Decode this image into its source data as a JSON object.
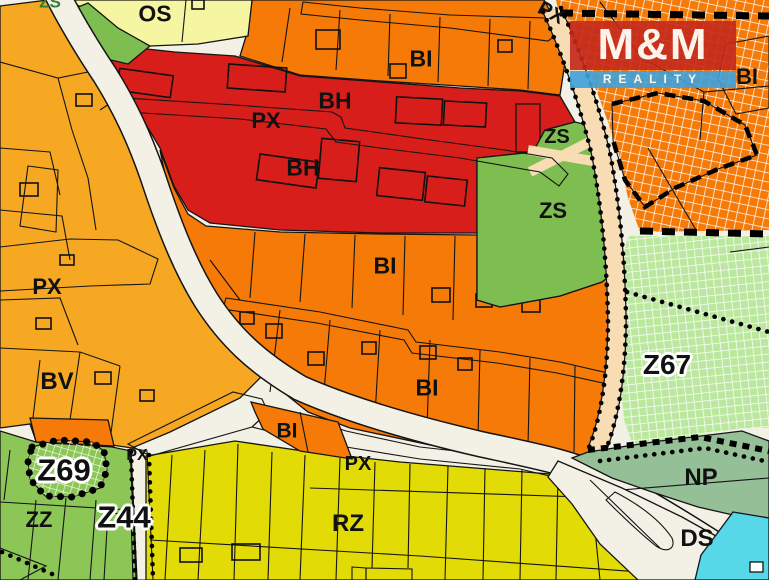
{
  "map": {
    "type": "zoning-plan-map",
    "colors": {
      "bi": "#F57A07",
      "bh": "#D81E1A",
      "bv": "#F7A823",
      "os": "#F6F6A2",
      "zs": "#7EBE51",
      "z67": "#BCE79E",
      "np": "#95BF97",
      "rz": "#E2DB06",
      "zz": "#8CC656",
      "water": "#57D8E9",
      "road": "#F3F0E6",
      "tan": "#F8DCB3",
      "z69": "#F6AC2F",
      "cream": "#F4E3C3",
      "logoRed": "#C5281C",
      "logoBlue": "#3FA3DC",
      "line": "#141414"
    },
    "zone_codes": [
      "BI",
      "BH",
      "BV",
      "OS",
      "ZS",
      "PX",
      "RZ",
      "ZZ",
      "NP",
      "DS",
      "Z44",
      "Z67",
      "Z69"
    ],
    "labels": [
      {
        "text": "ZS",
        "x": 50,
        "y": 2,
        "size": 17,
        "halo": false,
        "color": "#2f8032"
      },
      {
        "text": "OS",
        "x": 155,
        "y": 14,
        "size": 23,
        "halo": false
      },
      {
        "text": "PX",
        "x": 551,
        "y": 13,
        "size": 20,
        "halo": false,
        "rotate": 28
      },
      {
        "text": "BI",
        "x": 747,
        "y": 77,
        "size": 22,
        "halo": false
      },
      {
        "text": "BI",
        "x": 421,
        "y": 59,
        "size": 23,
        "halo": false
      },
      {
        "text": "BH",
        "x": 335,
        "y": 101,
        "size": 23,
        "halo": false
      },
      {
        "text": "PX",
        "x": 266,
        "y": 121,
        "size": 22,
        "halo": false
      },
      {
        "text": "ZS",
        "x": 557,
        "y": 137,
        "size": 20,
        "halo": false
      },
      {
        "text": "BH",
        "x": 303,
        "y": 168,
        "size": 23,
        "halo": false
      },
      {
        "text": "ZS",
        "x": 553,
        "y": 211,
        "size": 22,
        "halo": false
      },
      {
        "text": "BI",
        "x": 385,
        "y": 266,
        "size": 23,
        "halo": false
      },
      {
        "text": "PX",
        "x": 47,
        "y": 287,
        "size": 22,
        "halo": false
      },
      {
        "text": "BV",
        "x": 57,
        "y": 382,
        "size": 24,
        "halo": false
      },
      {
        "text": "BI",
        "x": 427,
        "y": 388,
        "size": 23,
        "halo": false
      },
      {
        "text": "Z67",
        "x": 667,
        "y": 365,
        "size": 28,
        "halo": true
      },
      {
        "text": "BI",
        "x": 287,
        "y": 431,
        "size": 21,
        "halo": false
      },
      {
        "text": "PX",
        "x": 358,
        "y": 464,
        "size": 20,
        "halo": false
      },
      {
        "text": "Z69",
        "x": 64,
        "y": 470,
        "size": 31,
        "halo": true
      },
      {
        "text": "PX",
        "x": 137,
        "y": 456,
        "size": 16,
        "halo": false
      },
      {
        "text": "ZZ",
        "x": 39,
        "y": 520,
        "size": 22,
        "halo": false
      },
      {
        "text": "Z44",
        "x": 124,
        "y": 517,
        "size": 31,
        "halo": true
      },
      {
        "text": "RZ",
        "x": 348,
        "y": 524,
        "size": 24,
        "halo": false
      },
      {
        "text": "NP",
        "x": 701,
        "y": 478,
        "size": 24,
        "halo": false
      },
      {
        "text": "DS",
        "x": 697,
        "y": 539,
        "size": 24,
        "halo": false
      }
    ],
    "watermark": {
      "line1": "M&M",
      "line2": "REALITY"
    }
  }
}
